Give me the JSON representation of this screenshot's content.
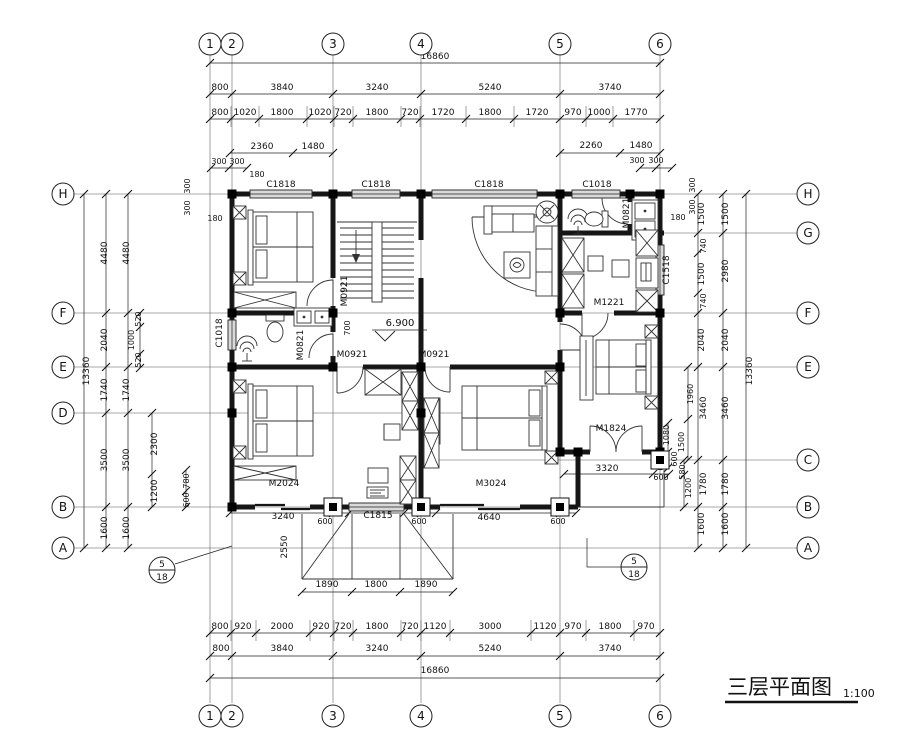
{
  "drawing": {
    "title": "三层平面图",
    "scale": "1:100",
    "level_mark": "6.900"
  },
  "grid_bubbles": {
    "top": [
      "1",
      "2",
      "3",
      "4",
      "5",
      "6"
    ],
    "bottom": [
      "1",
      "2",
      "3",
      "4",
      "5",
      "6"
    ],
    "left": [
      "H",
      "F",
      "E",
      "D",
      "B",
      "A"
    ],
    "right": [
      "H",
      "G",
      "F",
      "E",
      "C",
      "B",
      "A"
    ]
  },
  "detail_markers": [
    {
      "num": "5",
      "den": "18"
    },
    {
      "num": "5",
      "den": "18"
    }
  ],
  "dimensions": {
    "top": [
      {
        "t": "16860",
        "x": 435,
        "y": 59
      },
      {
        "t": "800",
        "x": 220,
        "y": 90
      },
      {
        "t": "3840",
        "x": 282,
        "y": 90
      },
      {
        "t": "3240",
        "x": 377,
        "y": 90
      },
      {
        "t": "5240",
        "x": 490,
        "y": 90
      },
      {
        "t": "3740",
        "x": 610,
        "y": 90
      },
      {
        "t": "800",
        "x": 220,
        "y": 115
      },
      {
        "t": "1020",
        "x": 245,
        "y": 115
      },
      {
        "t": "1800",
        "x": 282,
        "y": 115
      },
      {
        "t": "1020",
        "x": 320,
        "y": 115
      },
      {
        "t": "720",
        "x": 343,
        "y": 115
      },
      {
        "t": "1800",
        "x": 377,
        "y": 115
      },
      {
        "t": "720",
        "x": 410,
        "y": 115
      },
      {
        "t": "1720",
        "x": 443,
        "y": 115
      },
      {
        "t": "1800",
        "x": 490,
        "y": 115
      },
      {
        "t": "1720",
        "x": 537,
        "y": 115
      },
      {
        "t": "970",
        "x": 573,
        "y": 115
      },
      {
        "t": "1000",
        "x": 599,
        "y": 115
      },
      {
        "t": "1770",
        "x": 636,
        "y": 115
      },
      {
        "t": "2360",
        "x": 262,
        "y": 149
      },
      {
        "t": "1480",
        "x": 313,
        "y": 149
      },
      {
        "t": "2260",
        "x": 591,
        "y": 148
      },
      {
        "t": "1480",
        "x": 641,
        "y": 148
      },
      {
        "t": "300",
        "x": 219,
        "y": 164,
        "s": 8
      },
      {
        "t": "300",
        "x": 237,
        "y": 164,
        "s": 8
      },
      {
        "t": "300",
        "x": 637,
        "y": 163,
        "s": 8
      },
      {
        "t": "300",
        "x": 656,
        "y": 163,
        "s": 8
      },
      {
        "t": "300",
        "x": 190,
        "y": 186,
        "r": -90,
        "s": 8
      },
      {
        "t": "300",
        "x": 190,
        "y": 208,
        "r": -90,
        "s": 8
      },
      {
        "t": "300",
        "x": 695,
        "y": 185,
        "r": -90,
        "s": 8
      },
      {
        "t": "300",
        "x": 695,
        "y": 207,
        "r": -90,
        "s": 8
      },
      {
        "t": "180",
        "x": 257,
        "y": 177,
        "s": 8
      },
      {
        "t": "180",
        "x": 215,
        "y": 221,
        "s": 8
      },
      {
        "t": "180",
        "x": 678,
        "y": 220,
        "s": 8
      }
    ],
    "left": [
      {
        "t": "13360",
        "x": 89,
        "y": 371,
        "r": -90
      },
      {
        "t": "4480",
        "x": 107,
        "y": 253,
        "r": -90
      },
      {
        "t": "2040",
        "x": 107,
        "y": 340,
        "r": -90
      },
      {
        "t": "1740",
        "x": 107,
        "y": 390,
        "r": -90
      },
      {
        "t": "3500",
        "x": 107,
        "y": 460,
        "r": -90
      },
      {
        "t": "1600",
        "x": 107,
        "y": 528,
        "r": -90
      },
      {
        "t": "4480",
        "x": 129,
        "y": 253,
        "r": -90
      },
      {
        "t": "1740",
        "x": 129,
        "y": 390,
        "r": -90
      },
      {
        "t": "3500",
        "x": 129,
        "y": 460,
        "r": -90
      },
      {
        "t": "1600",
        "x": 129,
        "y": 528,
        "r": -90
      },
      {
        "t": "520",
        "x": 141,
        "y": 319,
        "r": -90,
        "s": 8
      },
      {
        "t": "1000",
        "x": 134,
        "y": 340,
        "r": -90,
        "s": 8
      },
      {
        "t": "520",
        "x": 141,
        "y": 360,
        "r": -90,
        "s": 8
      },
      {
        "t": "2300",
        "x": 157,
        "y": 444,
        "r": -90
      },
      {
        "t": "1200",
        "x": 157,
        "y": 491,
        "r": -90
      },
      {
        "t": "780",
        "x": 189,
        "y": 481,
        "r": -90,
        "s": 8
      },
      {
        "t": "600",
        "x": 189,
        "y": 500,
        "r": -90,
        "s": 8
      }
    ],
    "right": [
      {
        "t": "1500",
        "x": 704,
        "y": 214,
        "r": -90
      },
      {
        "t": "740",
        "x": 706,
        "y": 246,
        "r": -90,
        "s": 8
      },
      {
        "t": "1500",
        "x": 704,
        "y": 274,
        "r": -90
      },
      {
        "t": "740",
        "x": 706,
        "y": 301,
        "r": -90,
        "s": 8
      },
      {
        "t": "2040",
        "x": 704,
        "y": 340,
        "r": -90
      },
      {
        "t": "3460",
        "x": 706,
        "y": 408,
        "r": -90
      },
      {
        "t": "1780",
        "x": 706,
        "y": 484,
        "r": -90
      },
      {
        "t": "1600",
        "x": 704,
        "y": 524,
        "r": -90
      },
      {
        "t": "1500",
        "x": 728,
        "y": 214,
        "r": -90
      },
      {
        "t": "2980",
        "x": 728,
        "y": 271,
        "r": -90
      },
      {
        "t": "2040",
        "x": 728,
        "y": 340,
        "r": -90
      },
      {
        "t": "3460",
        "x": 728,
        "y": 408,
        "r": -90
      },
      {
        "t": "1780",
        "x": 728,
        "y": 484,
        "r": -90
      },
      {
        "t": "1600",
        "x": 728,
        "y": 524,
        "r": -90
      },
      {
        "t": "13360",
        "x": 752,
        "y": 371,
        "r": -90
      },
      {
        "t": "1960",
        "x": 693,
        "y": 394,
        "r": -90,
        "s": 8
      },
      {
        "t": "1080",
        "x": 669,
        "y": 435,
        "r": -90,
        "s": 8
      },
      {
        "t": "1500",
        "x": 684,
        "y": 442,
        "r": -90,
        "s": 8
      },
      {
        "t": "600",
        "x": 677,
        "y": 459,
        "r": -90,
        "s": 8
      },
      {
        "t": "580",
        "x": 685,
        "y": 472,
        "r": -90,
        "s": 8
      },
      {
        "t": "1200",
        "x": 691,
        "y": 488,
        "r": -90,
        "s": 8
      }
    ],
    "bottom": [
      {
        "t": "1890",
        "x": 327,
        "y": 587
      },
      {
        "t": "1800",
        "x": 376,
        "y": 587
      },
      {
        "t": "1890",
        "x": 426,
        "y": 587
      },
      {
        "t": "2550",
        "x": 287,
        "y": 547,
        "r": -90
      },
      {
        "t": "3240",
        "x": 283,
        "y": 519
      },
      {
        "t": "600",
        "x": 325,
        "y": 524,
        "s": 8
      },
      {
        "t": "600",
        "x": 419,
        "y": 524,
        "s": 8
      },
      {
        "t": "4640",
        "x": 489,
        "y": 520
      },
      {
        "t": "600",
        "x": 558,
        "y": 524,
        "s": 8
      },
      {
        "t": "3320",
        "x": 607,
        "y": 471
      },
      {
        "t": "600",
        "x": 661,
        "y": 480,
        "s": 8
      },
      {
        "t": "800",
        "x": 220,
        "y": 629
      },
      {
        "t": "920",
        "x": 243,
        "y": 629
      },
      {
        "t": "2000",
        "x": 282,
        "y": 629
      },
      {
        "t": "920",
        "x": 321,
        "y": 629
      },
      {
        "t": "720",
        "x": 343,
        "y": 629
      },
      {
        "t": "1800",
        "x": 377,
        "y": 629
      },
      {
        "t": "720",
        "x": 410,
        "y": 629
      },
      {
        "t": "1120",
        "x": 435,
        "y": 629
      },
      {
        "t": "3000",
        "x": 490,
        "y": 629
      },
      {
        "t": "1120",
        "x": 545,
        "y": 629
      },
      {
        "t": "970",
        "x": 573,
        "y": 629
      },
      {
        "t": "1800",
        "x": 610,
        "y": 629
      },
      {
        "t": "970",
        "x": 646,
        "y": 629
      },
      {
        "t": "800",
        "x": 221,
        "y": 651
      },
      {
        "t": "3840",
        "x": 282,
        "y": 651
      },
      {
        "t": "3240",
        "x": 377,
        "y": 651
      },
      {
        "t": "5240",
        "x": 490,
        "y": 651
      },
      {
        "t": "3740",
        "x": 610,
        "y": 651
      },
      {
        "t": "16860",
        "x": 435,
        "y": 673
      }
    ]
  },
  "labels": [
    {
      "t": "C1818",
      "x": 281,
      "y": 187
    },
    {
      "t": "C1818",
      "x": 376,
      "y": 187
    },
    {
      "t": "C1818",
      "x": 489,
      "y": 187
    },
    {
      "t": "C1018",
      "x": 597,
      "y": 187
    },
    {
      "t": "C1018",
      "x": 222,
      "y": 333,
      "r": -90
    },
    {
      "t": "C1518",
      "x": 669,
      "y": 270,
      "r": -90
    },
    {
      "t": "C1815",
      "x": 378,
      "y": 518
    },
    {
      "t": "M0821",
      "x": 629,
      "y": 213,
      "r": -90
    },
    {
      "t": "M0821",
      "x": 303,
      "y": 345,
      "r": -90
    },
    {
      "t": "M0921",
      "x": 347,
      "y": 291,
      "r": -90
    },
    {
      "t": "M0921",
      "x": 352,
      "y": 357
    },
    {
      "t": "M0921",
      "x": 434,
      "y": 357
    },
    {
      "t": "M1221",
      "x": 609,
      "y": 305
    },
    {
      "t": "M1824",
      "x": 611,
      "y": 431
    },
    {
      "t": "M2024",
      "x": 284,
      "y": 486
    },
    {
      "t": "M3024",
      "x": 491,
      "y": 486
    },
    {
      "t": "700",
      "x": 350,
      "y": 328,
      "r": -90,
      "s": 8
    }
  ]
}
